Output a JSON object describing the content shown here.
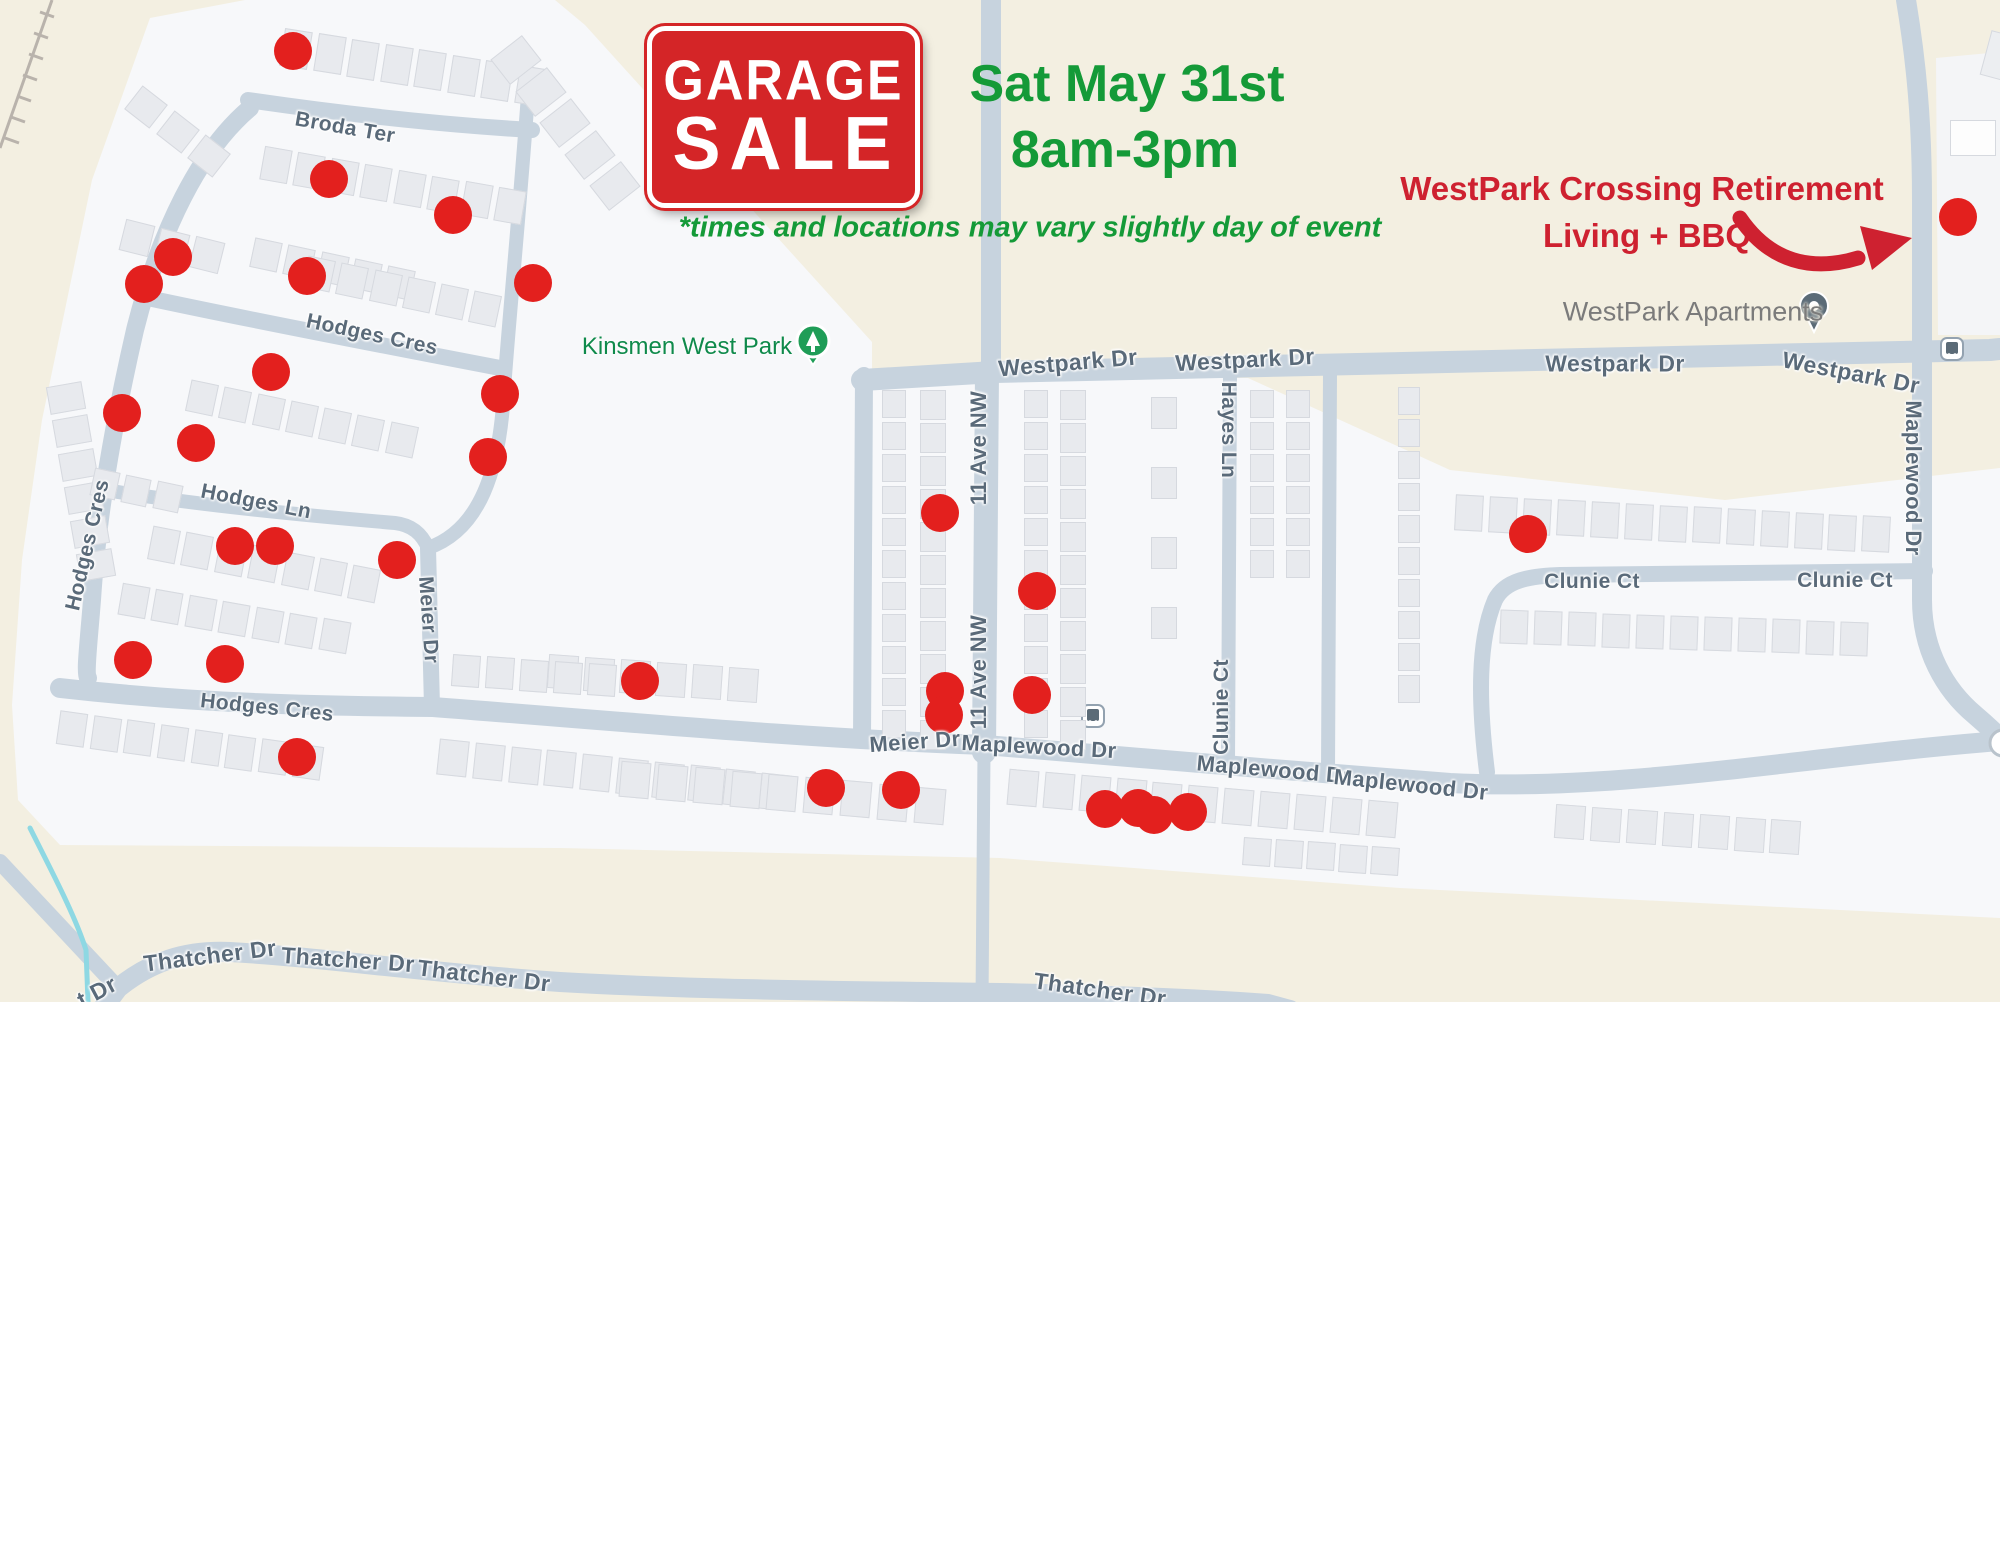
{
  "event": {
    "sign_line1": "GARAGE",
    "sign_line2": "SALE",
    "date": "Sat May 31st",
    "time": "8am-3pm",
    "note": "*times and locations may vary slightly day of event"
  },
  "callout": {
    "line1": "WestPark Crossing Retirement",
    "line2": "Living + BBQ"
  },
  "poi": {
    "park": "Kinsmen West Park",
    "apartments": "WestPark Apartments"
  },
  "colors": {
    "map_beige": "#f3efe1",
    "residential_gray": "#f7f8fa",
    "road": "#c7d3de",
    "building": "#e8eaee",
    "sale_dot": "#e3201e",
    "sign_red": "#d42527",
    "title_green": "#149a38",
    "callout_red": "#ce2130",
    "street_label": "#5a6a79",
    "stream_teal": "#8ed8e3",
    "park_green": "#1f9d57",
    "pin_slate": "#5b6b77"
  },
  "map": {
    "regions": [
      {
        "name": "residential-area-main",
        "points": "150,18 245,0 555,0 585,25 872,342 872,375 1248,378 1450,470 1725,500 2000,468 2000,918 1400,888 1000,858 560,848 60,845 18,800 12,705 22,560 42,420 92,180",
        "fill": "#f7f8fa"
      },
      {
        "name": "residential-area-northeast",
        "points": "1936,58 2000,52 2000,335 1938,335",
        "fill": "#f4f5f7"
      }
    ],
    "roads": [
      {
        "name": "westpark-dr",
        "d": "M 862 380 L 995 372 L 1990 350 L 2000 349",
        "w": 22
      },
      {
        "name": "north-stub",
        "d": "M 991 0 L 991 374",
        "w": 20
      },
      {
        "name": "11-ave-nw",
        "d": "M 987 372 L 984 752",
        "w": 24
      },
      {
        "name": "11-ave-nw-south",
        "d": "M 984 752 L 982 1002",
        "w": 13
      },
      {
        "name": "park-loop",
        "d": "M 864 376 L 862 740",
        "w": 18
      },
      {
        "name": "bottom-main",
        "d": "M 60 688 C 200 704 320 706 433 707 C 640 723 800 738 985 745 C 1120 756 1300 772 1450 783 C 1620 792 1800 757 2000 741",
        "w": 20
      },
      {
        "name": "clunie-loop",
        "d": "M 1487 772 C 1478 700 1478 640 1495 600 C 1505 580 1530 576 1560 575 L 1925 571",
        "w": 16
      },
      {
        "name": "maplewood-dr-vertical",
        "d": "M 1906 0 C 1916 60 1922 120 1922 200 L 1922 600 C 1922 650 1945 690 1975 715 C 1988 726 1996 734 2000 738",
        "w": 20
      },
      {
        "name": "hayes-ln",
        "d": "M 1230 376 L 1228 762",
        "w": 14
      },
      {
        "name": "clunie-connector",
        "d": "M 1330 374 L 1328 770",
        "w": 14
      },
      {
        "name": "hodges-cres-west",
        "d": "M 250 108 C 200 150 160 230 135 330 C 112 430 97 520 92 600 C 88 650 85 672 88 678",
        "w": 18
      },
      {
        "name": "broda-ter",
        "d": "M 248 100 C 330 112 430 124 532 130",
        "w": 16
      },
      {
        "name": "east-vertical",
        "d": "M 528 95 C 518 230 508 330 504 390 C 500 470 480 530 428 548",
        "w": 14
      },
      {
        "name": "hodges-cres-top",
        "d": "M 148 298 C 250 320 380 345 500 368",
        "w": 16
      },
      {
        "name": "hodges-ln",
        "d": "M 118 492 C 200 505 300 515 395 523 C 412 525 422 534 428 548",
        "w": 14
      },
      {
        "name": "meier-dr-vertical",
        "d": "M 428 548 L 432 707",
        "w": 16
      },
      {
        "name": "southwest-diagonal",
        "d": "M 0 862 L 118 988",
        "w": 16
      },
      {
        "name": "thatcher-dr",
        "d": "M 100 1012 L 118 988 C 150 962 185 950 230 952 C 320 957 420 972 560 982 C 700 990 850 991 1000 993 C 1100 995 1200 999 1268 1004 L 1290 1010",
        "w": 20
      }
    ],
    "stream": {
      "d": "M 30 828 C 50 868 75 915 86 950 L 88 1002",
      "w": 5
    },
    "railway": {
      "d": "M 52 0 L 0 148",
      "ticks": [
        [
          54,
          17,
          40,
          12
        ],
        [
          48,
          38,
          34,
          33
        ],
        [
          43,
          59,
          29,
          54
        ],
        [
          37,
          80,
          23,
          75
        ],
        [
          31,
          101,
          17,
          96
        ],
        [
          25,
          122,
          11,
          117
        ],
        [
          19,
          143,
          5,
          138
        ]
      ]
    },
    "street_labels": [
      {
        "t": "Broda Ter",
        "x": 345,
        "y": 128,
        "r": 10,
        "s": 21
      },
      {
        "t": "Hodges Cres",
        "x": 372,
        "y": 335,
        "r": 12,
        "s": 21
      },
      {
        "t": "Hodges Cres",
        "x": 88,
        "y": 545,
        "r": -77,
        "s": 21
      },
      {
        "t": "Hodges Ln",
        "x": 256,
        "y": 502,
        "r": 11,
        "s": 21
      },
      {
        "t": "Hodges Cres",
        "x": 267,
        "y": 708,
        "r": 6,
        "s": 21
      },
      {
        "t": "Meier Dr",
        "x": 428,
        "y": 620,
        "r": 86,
        "s": 21
      },
      {
        "t": "Meier Dr",
        "x": 915,
        "y": 742,
        "r": -4,
        "s": 22
      },
      {
        "t": "11 Ave NW",
        "x": 979,
        "y": 448,
        "r": -90,
        "s": 22
      },
      {
        "t": "11 Ave NW",
        "x": 979,
        "y": 672,
        "r": -90,
        "s": 22
      },
      {
        "t": "Westpark Dr",
        "x": 1068,
        "y": 363,
        "r": -5,
        "s": 23
      },
      {
        "t": "Westpark Dr",
        "x": 1245,
        "y": 360,
        "r": -3,
        "s": 23
      },
      {
        "t": "Westpark Dr",
        "x": 1615,
        "y": 364,
        "r": 0,
        "s": 23
      },
      {
        "t": "Westpark Dr",
        "x": 1851,
        "y": 373,
        "r": 11,
        "s": 23
      },
      {
        "t": "Hayes Ln",
        "x": 1228,
        "y": 430,
        "r": 90,
        "s": 21
      },
      {
        "t": "Clunie Ct",
        "x": 1222,
        "y": 707,
        "r": -90,
        "s": 21
      },
      {
        "t": "Clunie Ct",
        "x": 1592,
        "y": 582,
        "r": 0,
        "s": 21
      },
      {
        "t": "Clunie Ct",
        "x": 1845,
        "y": 581,
        "r": 0,
        "s": 21
      },
      {
        "t": "Maplewood Dr",
        "x": 1913,
        "y": 478,
        "r": 90,
        "s": 22
      },
      {
        "t": "Maplewood Dr",
        "x": 1039,
        "y": 747,
        "r": 3,
        "s": 22
      },
      {
        "t": "Maplewood Dr",
        "x": 1274,
        "y": 770,
        "r": 5,
        "s": 22
      },
      {
        "t": "Maplewood Dr",
        "x": 1411,
        "y": 785,
        "r": 6,
        "s": 22
      },
      {
        "t": "Thatcher Dr",
        "x": 210,
        "y": 956,
        "r": -7,
        "s": 23
      },
      {
        "t": "Thatcher Dr",
        "x": 348,
        "y": 960,
        "r": 4,
        "s": 23
      },
      {
        "t": "Thatcher Dr",
        "x": 484,
        "y": 976,
        "r": 7,
        "s": 23
      },
      {
        "t": "Thatcher Dr",
        "x": 1100,
        "y": 990,
        "r": 8,
        "s": 23
      },
      {
        "t": "t Dr",
        "x": 97,
        "y": 992,
        "r": -28,
        "s": 23
      }
    ],
    "sale_dots": [
      [
        293,
        51
      ],
      [
        329,
        179
      ],
      [
        453,
        215
      ],
      [
        173,
        257
      ],
      [
        144,
        284
      ],
      [
        307,
        276
      ],
      [
        533,
        283
      ],
      [
        271,
        372
      ],
      [
        500,
        394
      ],
      [
        122,
        413
      ],
      [
        196,
        443
      ],
      [
        488,
        457
      ],
      [
        235,
        546
      ],
      [
        275,
        546
      ],
      [
        397,
        560
      ],
      [
        940,
        513
      ],
      [
        1037,
        591
      ],
      [
        133,
        660
      ],
      [
        225,
        664
      ],
      [
        640,
        681
      ],
      [
        945,
        691
      ],
      [
        944,
        715
      ],
      [
        1032,
        695
      ],
      [
        297,
        757
      ],
      [
        826,
        788
      ],
      [
        901,
        790
      ],
      [
        1105,
        809
      ],
      [
        1138,
        808
      ],
      [
        1154,
        815
      ],
      [
        1188,
        812
      ],
      [
        1528,
        534
      ],
      [
        1958,
        217
      ]
    ],
    "building_rows": [
      [
        282,
        30,
        9,
        8,
        26,
        36,
        8
      ],
      [
        130,
        92,
        38,
        3,
        30,
        28,
        10
      ],
      [
        500,
        40,
        52,
        5,
        30,
        38,
        10
      ],
      [
        262,
        148,
        10,
        8,
        26,
        32,
        8
      ],
      [
        122,
        222,
        14,
        3,
        28,
        30,
        8
      ],
      [
        252,
        240,
        12,
        5,
        26,
        28,
        8
      ],
      [
        305,
        258,
        12,
        6,
        26,
        30,
        8
      ],
      [
        52,
        380,
        80,
        6,
        26,
        34,
        8
      ],
      [
        188,
        382,
        12,
        7,
        26,
        30,
        8
      ],
      [
        92,
        470,
        12,
        3,
        24,
        26,
        8
      ],
      [
        150,
        528,
        11,
        7,
        26,
        32,
        8
      ],
      [
        120,
        585,
        10,
        7,
        26,
        30,
        8
      ],
      [
        548,
        655,
        4,
        6,
        28,
        32,
        8
      ],
      [
        452,
        655,
        4,
        5,
        26,
        30,
        8
      ],
      [
        58,
        712,
        8,
        8,
        26,
        32,
        8
      ],
      [
        438,
        740,
        6,
        10,
        28,
        34,
        8
      ],
      [
        880,
        392,
        90,
        11,
        26,
        22,
        6
      ],
      [
        918,
        392,
        90,
        11,
        28,
        24,
        5
      ],
      [
        1022,
        392,
        90,
        11,
        26,
        22,
        6
      ],
      [
        1058,
        392,
        90,
        11,
        28,
        24,
        5
      ],
      [
        1148,
        400,
        90,
        4,
        30,
        24,
        40
      ],
      [
        1248,
        392,
        90,
        6,
        26,
        22,
        6
      ],
      [
        1284,
        392,
        90,
        6,
        26,
        22,
        6
      ],
      [
        1395,
        390,
        90,
        10,
        26,
        20,
        6
      ],
      [
        620,
        762,
        5,
        9,
        28,
        34,
        9
      ],
      [
        1008,
        770,
        5,
        11,
        28,
        34,
        8
      ],
      [
        1243,
        838,
        4,
        5,
        26,
        26,
        6
      ],
      [
        1555,
        805,
        4,
        7,
        28,
        32,
        8
      ],
      [
        1455,
        495,
        3,
        13,
        26,
        34,
        8
      ],
      [
        1500,
        610,
        2,
        11,
        26,
        32,
        8
      ],
      [
        1950,
        120,
        0,
        2,
        44,
        34,
        16,
        "#fdfdfd"
      ],
      [
        1985,
        34,
        15,
        1,
        34,
        44,
        8,
        "#eceef1"
      ]
    ],
    "icons": {
      "park_pin": {
        "x": 813,
        "y": 341
      },
      "apartments_pin": {
        "x": 1814,
        "y": 306
      },
      "bus_stops": [
        [
          1952,
          349
        ],
        [
          1093,
          716
        ]
      ],
      "edge_circle": [
        2003,
        743
      ]
    },
    "arrow": {
      "d": "M 1740 218 C 1770 262 1812 272 1858 258",
      "head": "1912,238 1860,226 1872,270"
    }
  }
}
